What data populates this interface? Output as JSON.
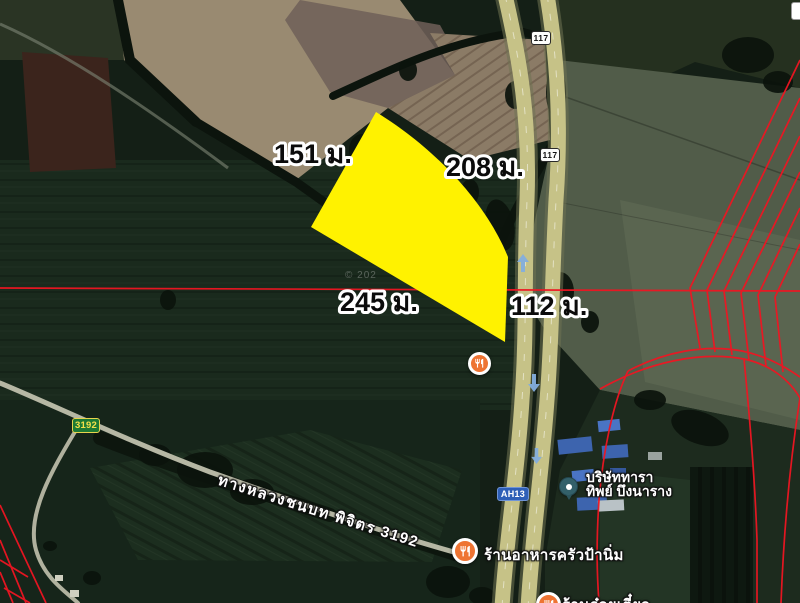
{
  "map_overlay": {
    "measurements": [
      {
        "side": "north-west",
        "label": "151 ม."
      },
      {
        "side": "north-east",
        "label": "208 ม."
      },
      {
        "side": "south-west",
        "label": "245 ม."
      },
      {
        "side": "east-road-frontage",
        "label": "112 ม."
      }
    ],
    "route_shields": {
      "highway_117_top": "117",
      "highway_117_mid": "117",
      "asian_highway": "AH13",
      "rural_route": "3192"
    },
    "road_name": "ทางหลวงชนบท พิจิตร 3192",
    "places": {
      "restaurant_1": "ร้านอาหารครัวป้านิ่ม",
      "company_line1": "บริษัททารา",
      "company_line2": "ทิพย์ บึงนาราง",
      "restaurant_clipped": "ร้านก๋วยเตี๋ยว"
    },
    "watermark": "© 202",
    "colors": {
      "plot_highlight": "#fff200",
      "parcel_line": "#ef1522",
      "restaurant_marker": "#ee7433",
      "place_marker": "#33606a",
      "highway_fill": "#c6c287",
      "shield_117_bg": "#ffffff",
      "shield_ah13_bg": "#2e5fb7",
      "shield_3192_bg": "#1e7a34"
    }
  }
}
